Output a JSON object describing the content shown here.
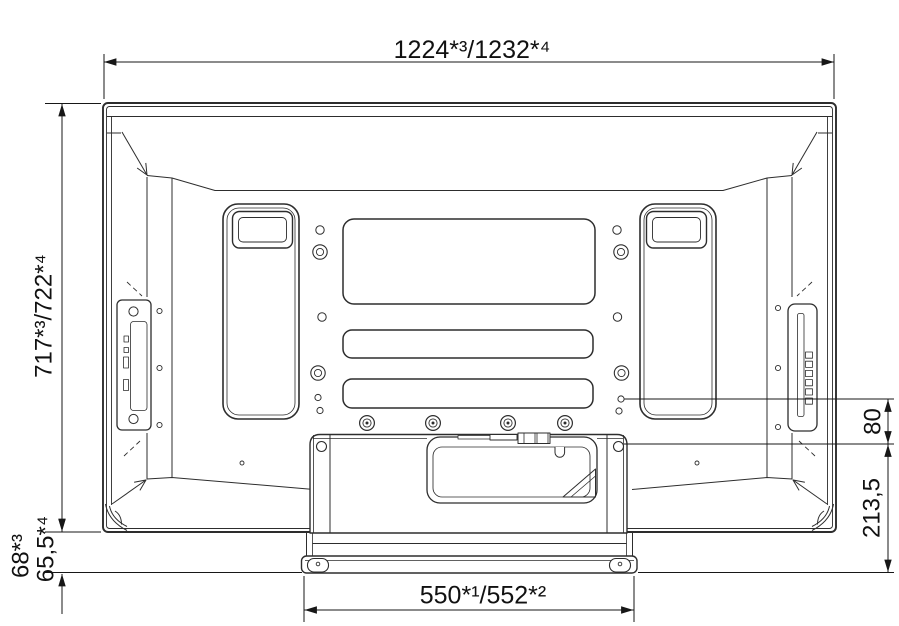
{
  "diagram": {
    "type": "technical-dimension-drawing",
    "subject": "flat panel display rear view with table stand",
    "units": "mm",
    "labels": {
      "top_width": "1224*³/1232*⁴",
      "left_height": "717*³/722*⁴",
      "stand_below_a": "68*³",
      "stand_below_b": "65,5*⁴",
      "hole_offset": "80",
      "stand_drop": "213,5",
      "base_width": "550*¹/552*²"
    },
    "colors": {
      "background": "#ffffff",
      "outline": "#2d2d2d",
      "dimension_line": "#171717",
      "text": "#111111"
    }
  }
}
